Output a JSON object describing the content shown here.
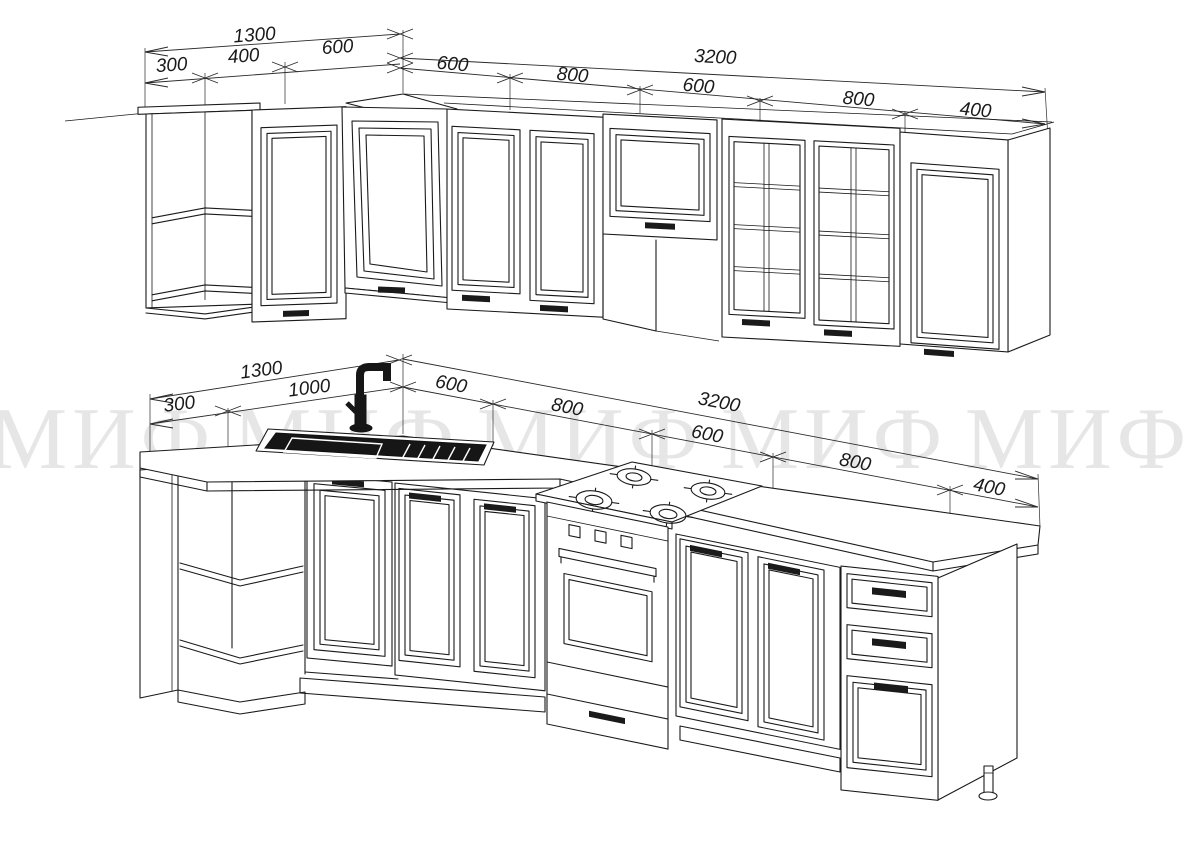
{
  "document": {
    "type": "technical-drawing",
    "subject": "L-shaped kitchen set, line drawing, upper and base cabinet rows with millimetre dimensions",
    "background": "#ffffff",
    "line_color": "#1a1a1a"
  },
  "watermark": {
    "text": "МИФ",
    "repeat": 5,
    "color": "#1a1a1a",
    "opacity": 0.1
  },
  "dims": {
    "upper": {
      "overall_left": "1300",
      "overall_right": "3200",
      "left_segments": [
        "300",
        "400",
        "600"
      ],
      "right_segments": [
        "600",
        "800",
        "600",
        "800",
        "400"
      ]
    },
    "lower": {
      "overall_left": "1300",
      "overall_right": "3200",
      "left_segments": [
        "300",
        "1000"
      ],
      "right_segments": [
        "600",
        "800",
        "600",
        "800",
        "400"
      ]
    }
  }
}
